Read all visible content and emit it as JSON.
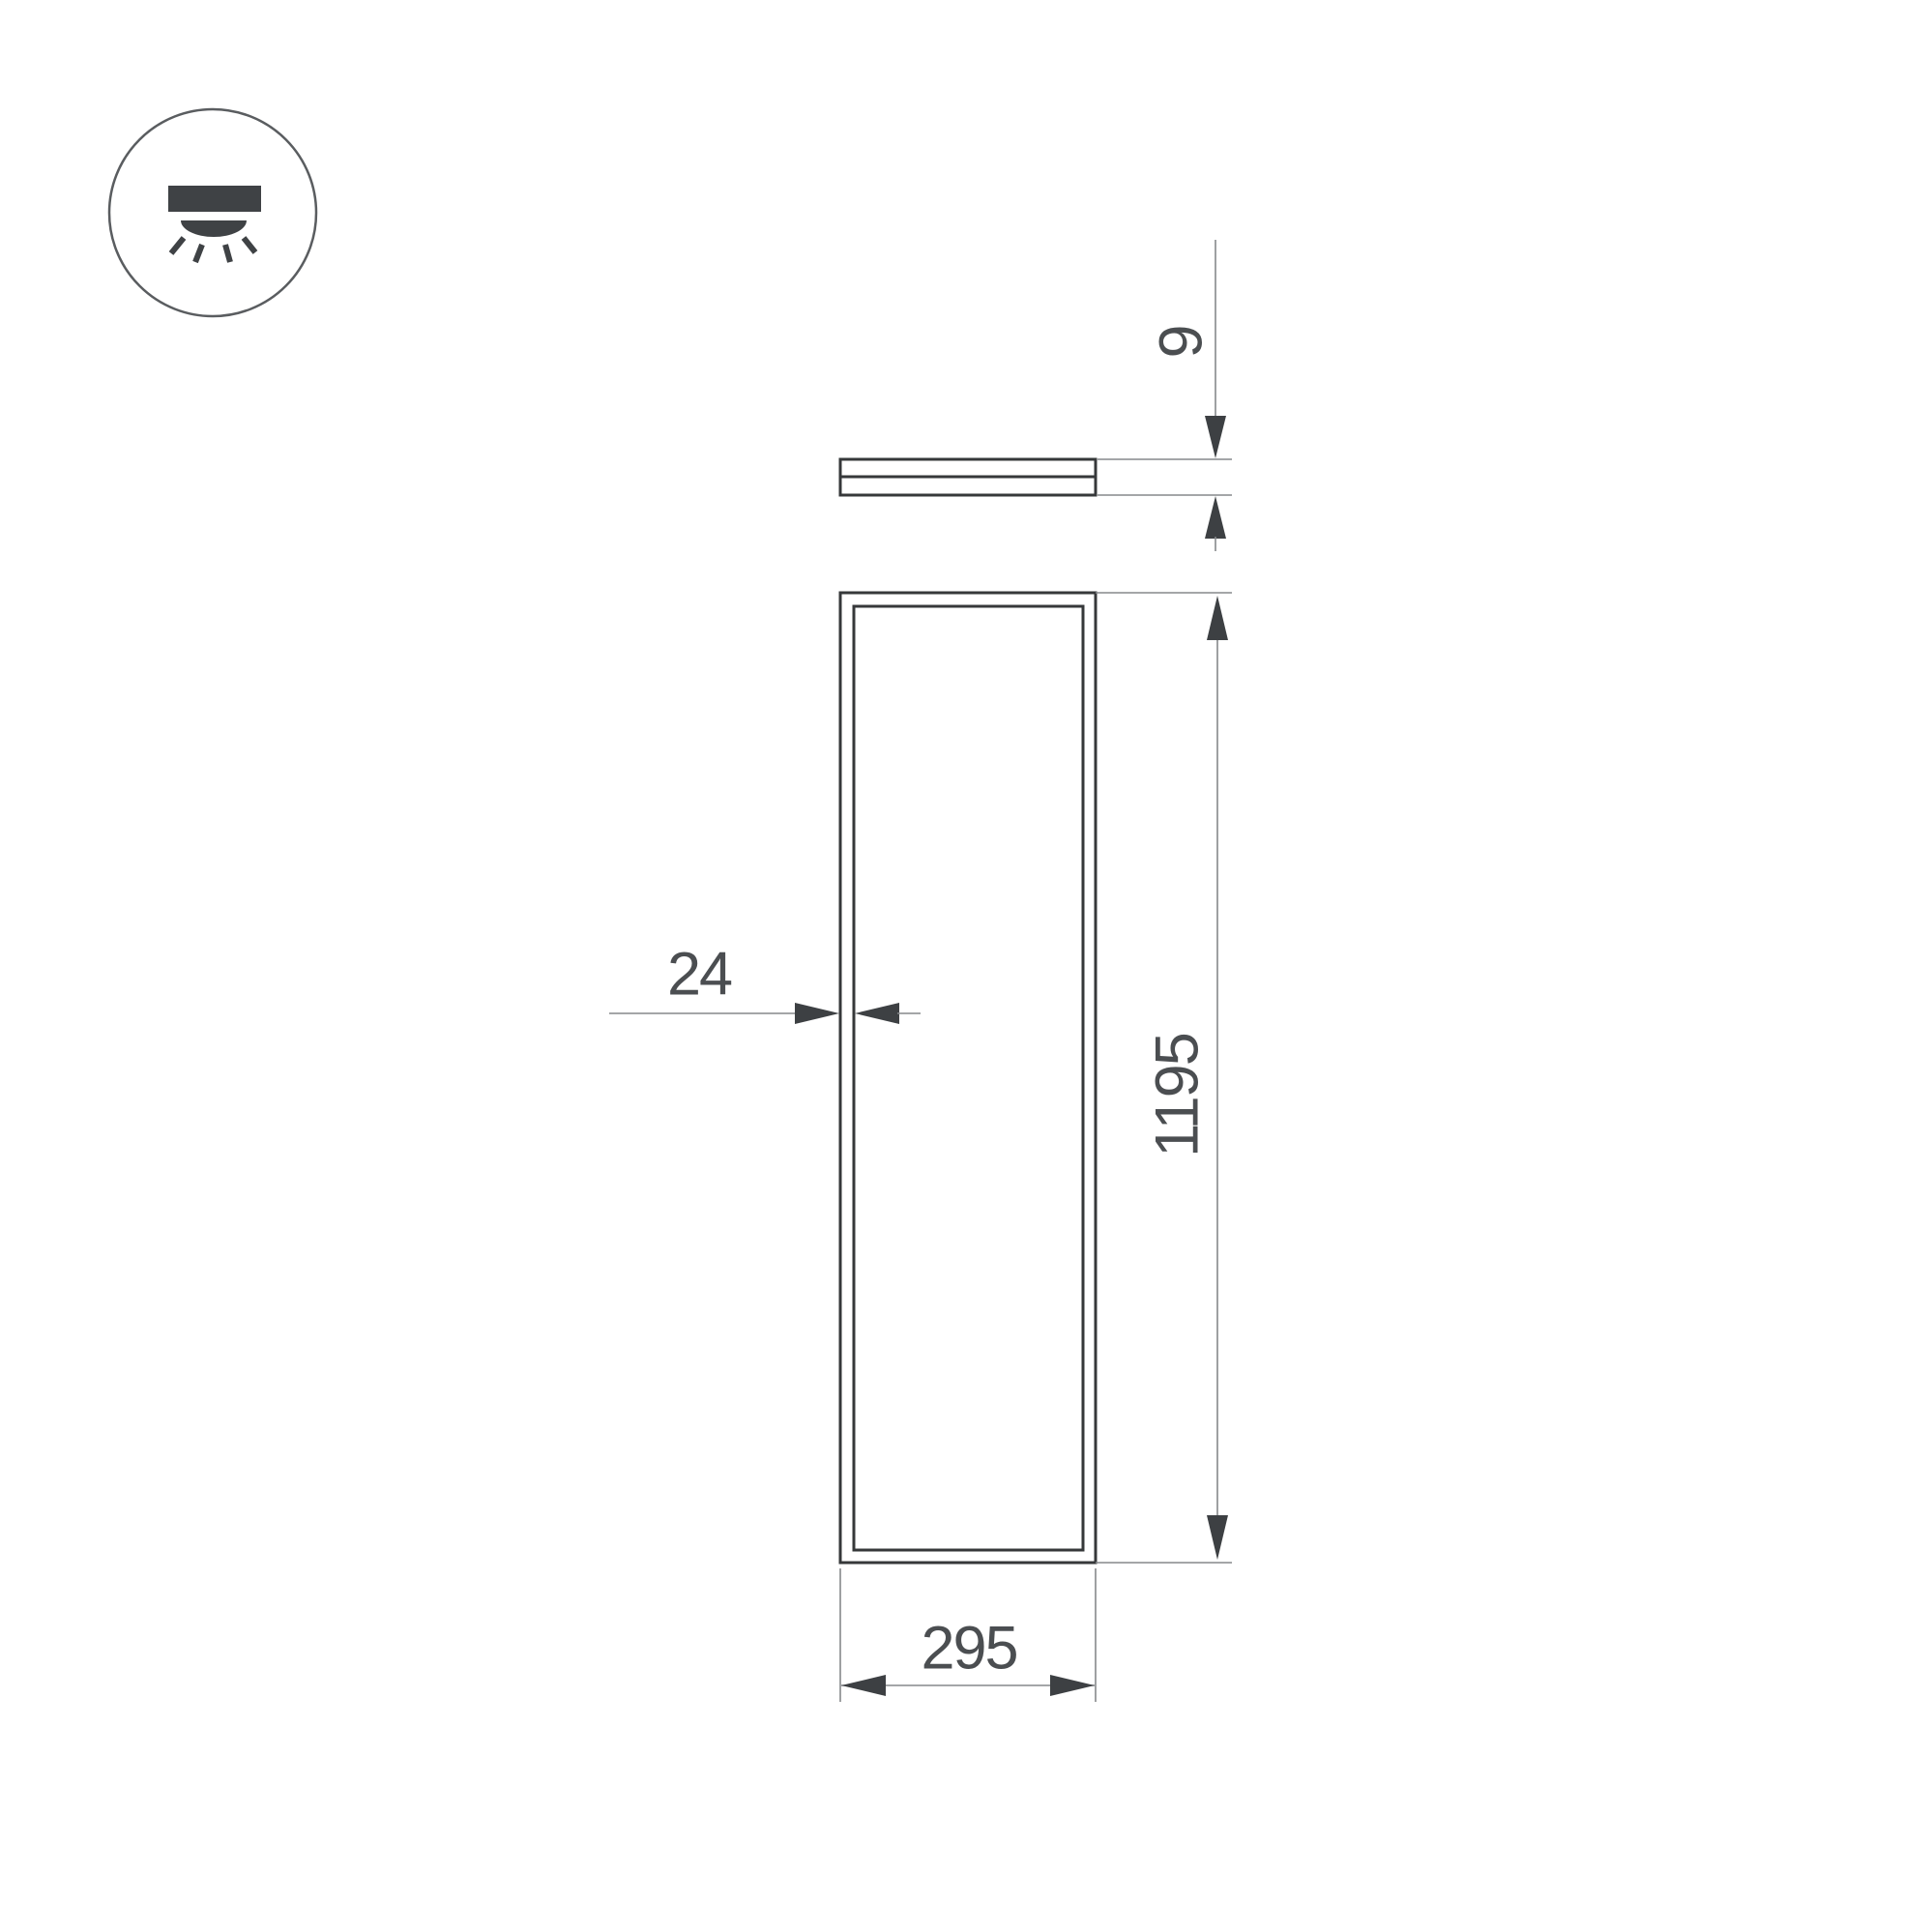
{
  "drawing": {
    "icon": "surface-downlight-icon",
    "labels": {
      "height_mm": "9",
      "frame_mm": "24",
      "length_mm": "1195",
      "width_mm": "295"
    },
    "colors": {
      "background": "#ffffff",
      "outline": "#36383a",
      "thin_line": "#85888b",
      "arrow_fill": "#3d4043",
      "label_text": "#4b4e51",
      "icon_glyph": "#3f4245"
    }
  }
}
